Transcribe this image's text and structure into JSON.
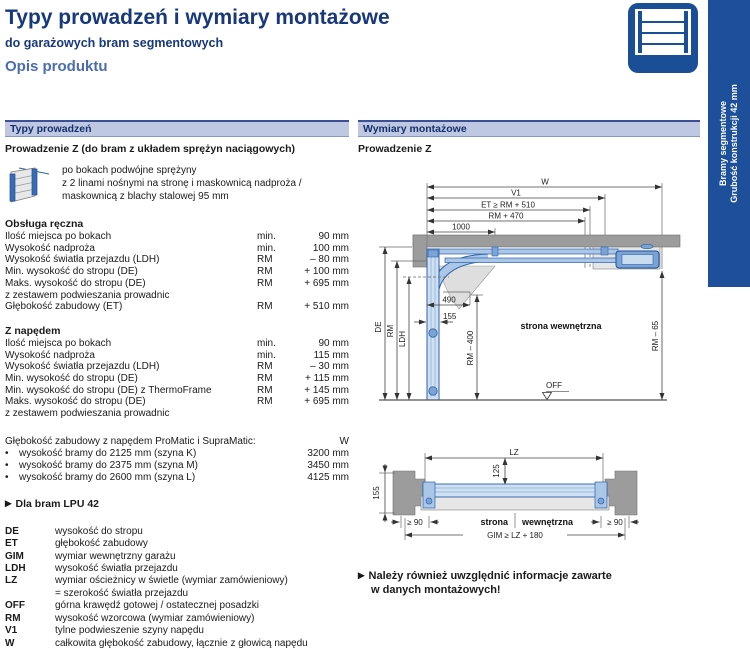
{
  "page": {
    "title": "Typy prowadzeń i wymiary montażowe",
    "subtitle": "do garażowych bram segmentowych",
    "section": "Opis produktu"
  },
  "side_tab": {
    "line1": "Bramy segmentowe",
    "line2": "Grubość konstrukcji 42 mm"
  },
  "marker": "▶",
  "bullet": "•",
  "left": {
    "header": "Typy prowadzeń",
    "subheader": "Prowadzenie Z (do bram z układem sprężyn naciągowych)",
    "intro_line1": "po bokach podwójne sprężyny",
    "intro_line2": "z 2 linami nośnymi na stronę i maskownicą nadproża /",
    "intro_line3": "maskownicą z blachy stalowej 95 mm",
    "manual": {
      "title": "Obsługa ręczna",
      "rows": [
        {
          "label": "Ilość miejsca po bokach",
          "unit": "min.",
          "value": "90 mm"
        },
        {
          "label": "Wysokość nadproża",
          "unit": "min.",
          "value": "100 mm"
        },
        {
          "label": "Wysokość światła przejazdu (LDH)",
          "unit": "RM",
          "value": "– 80 mm"
        },
        {
          "label": "Min. wysokość do stropu (DE)",
          "unit": "RM",
          "value": "+ 100 mm"
        },
        {
          "label": "Maks. wysokość do stropu (DE)",
          "unit": "RM",
          "value": "+ 695 mm"
        },
        {
          "label": "z zestawem podwieszania prowadnic",
          "unit": "",
          "value": ""
        },
        {
          "label": "Głębokość zabudowy (ET)",
          "unit": "RM",
          "value": "+ 510 mm"
        }
      ]
    },
    "powered": {
      "title": "Z napędem",
      "rows": [
        {
          "label": "Ilość miejsca po bokach",
          "unit": "min.",
          "value": "90 mm"
        },
        {
          "label": "Wysokość nadproża",
          "unit": "min.",
          "value": "115 mm"
        },
        {
          "label": "Wysokość światła przejazdu (LDH)",
          "unit": "RM",
          "value": "– 30 mm"
        },
        {
          "label": "Min. wysokość do stropu (DE)",
          "unit": "RM",
          "value": "+ 115 mm"
        },
        {
          "label": "Min. wysokość do stropu (DE) z ThermoFrame",
          "unit": "RM",
          "value": "+ 145 mm"
        },
        {
          "label": "Maks. wysokość do stropu (DE)",
          "unit": "RM",
          "value": "+ 695 mm"
        },
        {
          "label": "z zestawem podwieszania prowadnic",
          "unit": "",
          "value": ""
        }
      ]
    },
    "depth": {
      "label": "Głębokość zabudowy z napędem ProMatic i SupraMatic:",
      "value": "W",
      "rows": [
        {
          "label": "wysokość bramy do 2125 mm (szyna K)",
          "value": "3200 mm"
        },
        {
          "label": "wysokość bramy do 2375 mm (szyna M)",
          "value": "3450 mm"
        },
        {
          "label": "wysokość bramy do 2600 mm (szyna L)",
          "value": "4125 mm"
        }
      ]
    },
    "lpu_note": "Dla bram LPU 42",
    "legend": [
      {
        "abbr": "DE",
        "text": "wysokość do stropu",
        "text2": ""
      },
      {
        "abbr": "ET",
        "text": "głębokość zabudowy",
        "text2": ""
      },
      {
        "abbr": "GIM",
        "text": "wymiar wewnętrzny garażu",
        "text2": ""
      },
      {
        "abbr": "LDH",
        "text": "wysokość światła przejazdu",
        "text2": ""
      },
      {
        "abbr": "LZ",
        "text": "wymiar ościeżnicy w świetle (wymiar zamówieniowy)",
        "text2": "= szerokość światła przejazdu"
      },
      {
        "abbr": "OFF",
        "text": "górna krawędź gotowej / ostatecznej posadzki",
        "text2": ""
      },
      {
        "abbr": "RM",
        "text": "wysokość wzorcowa (wymiar zamówieniowy)",
        "text2": ""
      },
      {
        "abbr": "V1",
        "text": "tylne podwieszenie szyny napędu",
        "text2": ""
      },
      {
        "abbr": "W",
        "text": "całkowita głębokość zabudowy, łącznie z głowicą napędu",
        "text2": ""
      }
    ]
  },
  "right": {
    "header": "Wymiary montażowe",
    "subheader": "Prowadzenie Z",
    "diagram1": {
      "w": "W",
      "v1": "V1",
      "et": "ET ≥ RM + 510",
      "rm470": "RM + 470",
      "d1000": "1000",
      "d490": "490",
      "d155": "155",
      "de": "DE",
      "rm": "RM",
      "ldh": "LDH",
      "rm400": "RM – 400",
      "rm65": "RM – 65",
      "off": "OFF",
      "inside": "strona wewnętrzna"
    },
    "diagram2": {
      "lz": "LZ",
      "d125": "125",
      "d155": "155",
      "ge90l": "≥ 90",
      "ge90r": "≥ 90",
      "gim": "GIM ≥ LZ + 180",
      "inside1": "strona",
      "inside2": "wewnętrzna"
    },
    "note_line1": "Należy również uwzględnić informacje zawarte",
    "note_line2": "w danych montażowych!"
  },
  "colors": {
    "accent_navy": "#17387d",
    "accent_blue": "#4a6cb0",
    "tab_blue": "#1d4f9b",
    "bar_bg": "#bfc8e2",
    "drawing_blue": "#2e62a8",
    "drawing_fill": "#cfe0f2",
    "wall_gray": "#9c9c9c"
  }
}
